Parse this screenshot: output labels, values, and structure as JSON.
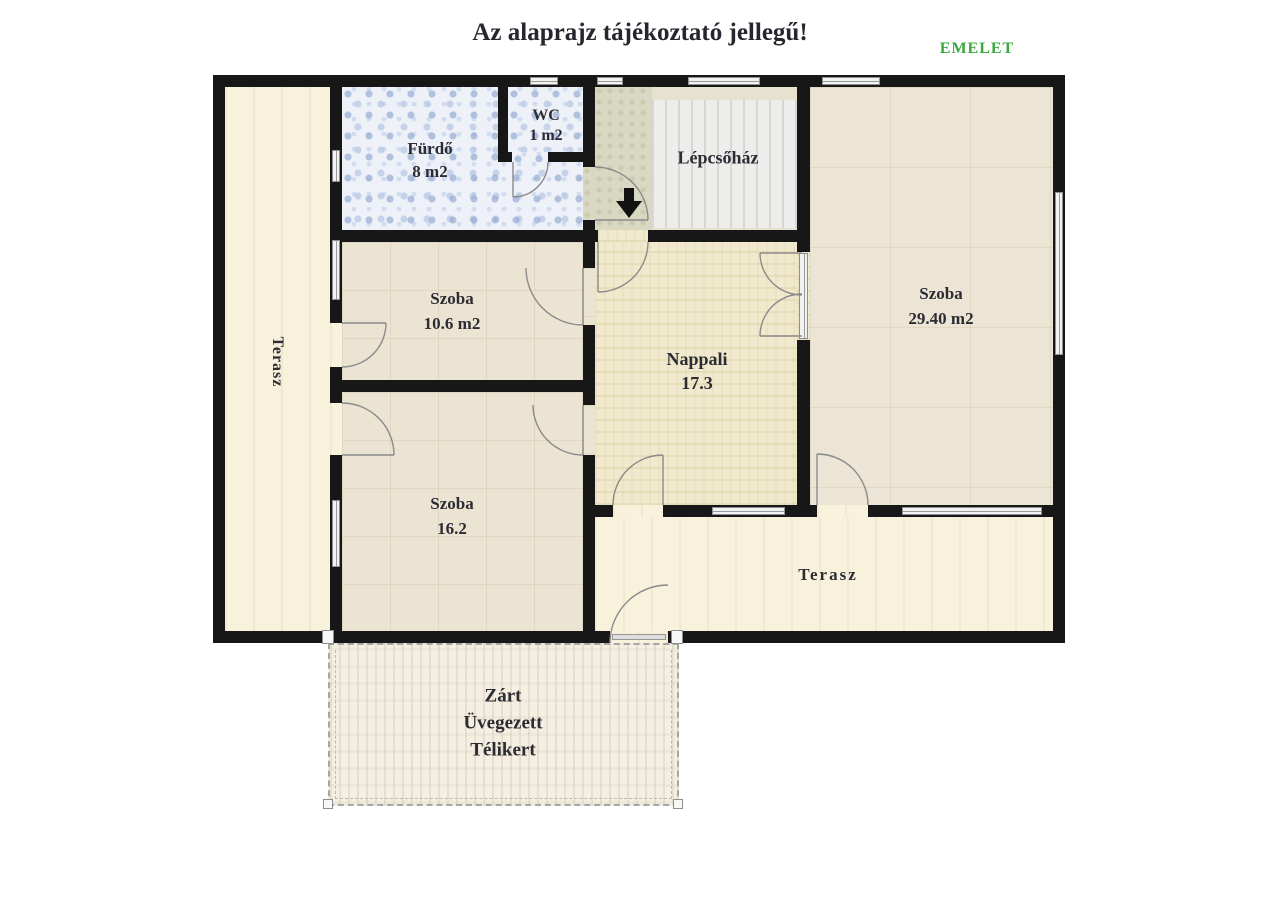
{
  "header": {
    "title": "Az alaprajz tájékoztató jellegű!",
    "floor_label": "EMELET"
  },
  "colors": {
    "floor_label_green": "#3aa83c",
    "wall": "#171717",
    "terasz_floor": "#f8f1dc",
    "szoba_floor": "#ece4d2",
    "nappali_floor": "#f0e9cd",
    "bathroom_tile": "#eef1f8",
    "bathroom_tile_dot": "#94acd2",
    "hall_floor": "#d9d8c2",
    "stairs_floor": "#ededeb",
    "garden_floor": "#f4efe2",
    "label_text": "#2c2c34"
  },
  "rooms": {
    "terasz_left": {
      "label": "Terasz"
    },
    "furdo": {
      "label": "Fürdő",
      "area": "8 m2"
    },
    "wc": {
      "label": "WC",
      "area": "1 m2"
    },
    "lepcsohaz": {
      "label": "Lépcsőház"
    },
    "szoba_small": {
      "label": "Szoba",
      "area": "10.6 m2"
    },
    "nappali": {
      "label": "Nappali",
      "area": "17.3"
    },
    "szoba_large": {
      "label": "Szoba",
      "area": "29.40 m2"
    },
    "szoba_mid": {
      "label": "Szoba",
      "area": "16.2"
    },
    "terasz_bottom": {
      "label": "Terasz"
    },
    "telikert": {
      "line1": "Zárt",
      "line2": "Üvegezett",
      "line3": "Télikert"
    }
  }
}
